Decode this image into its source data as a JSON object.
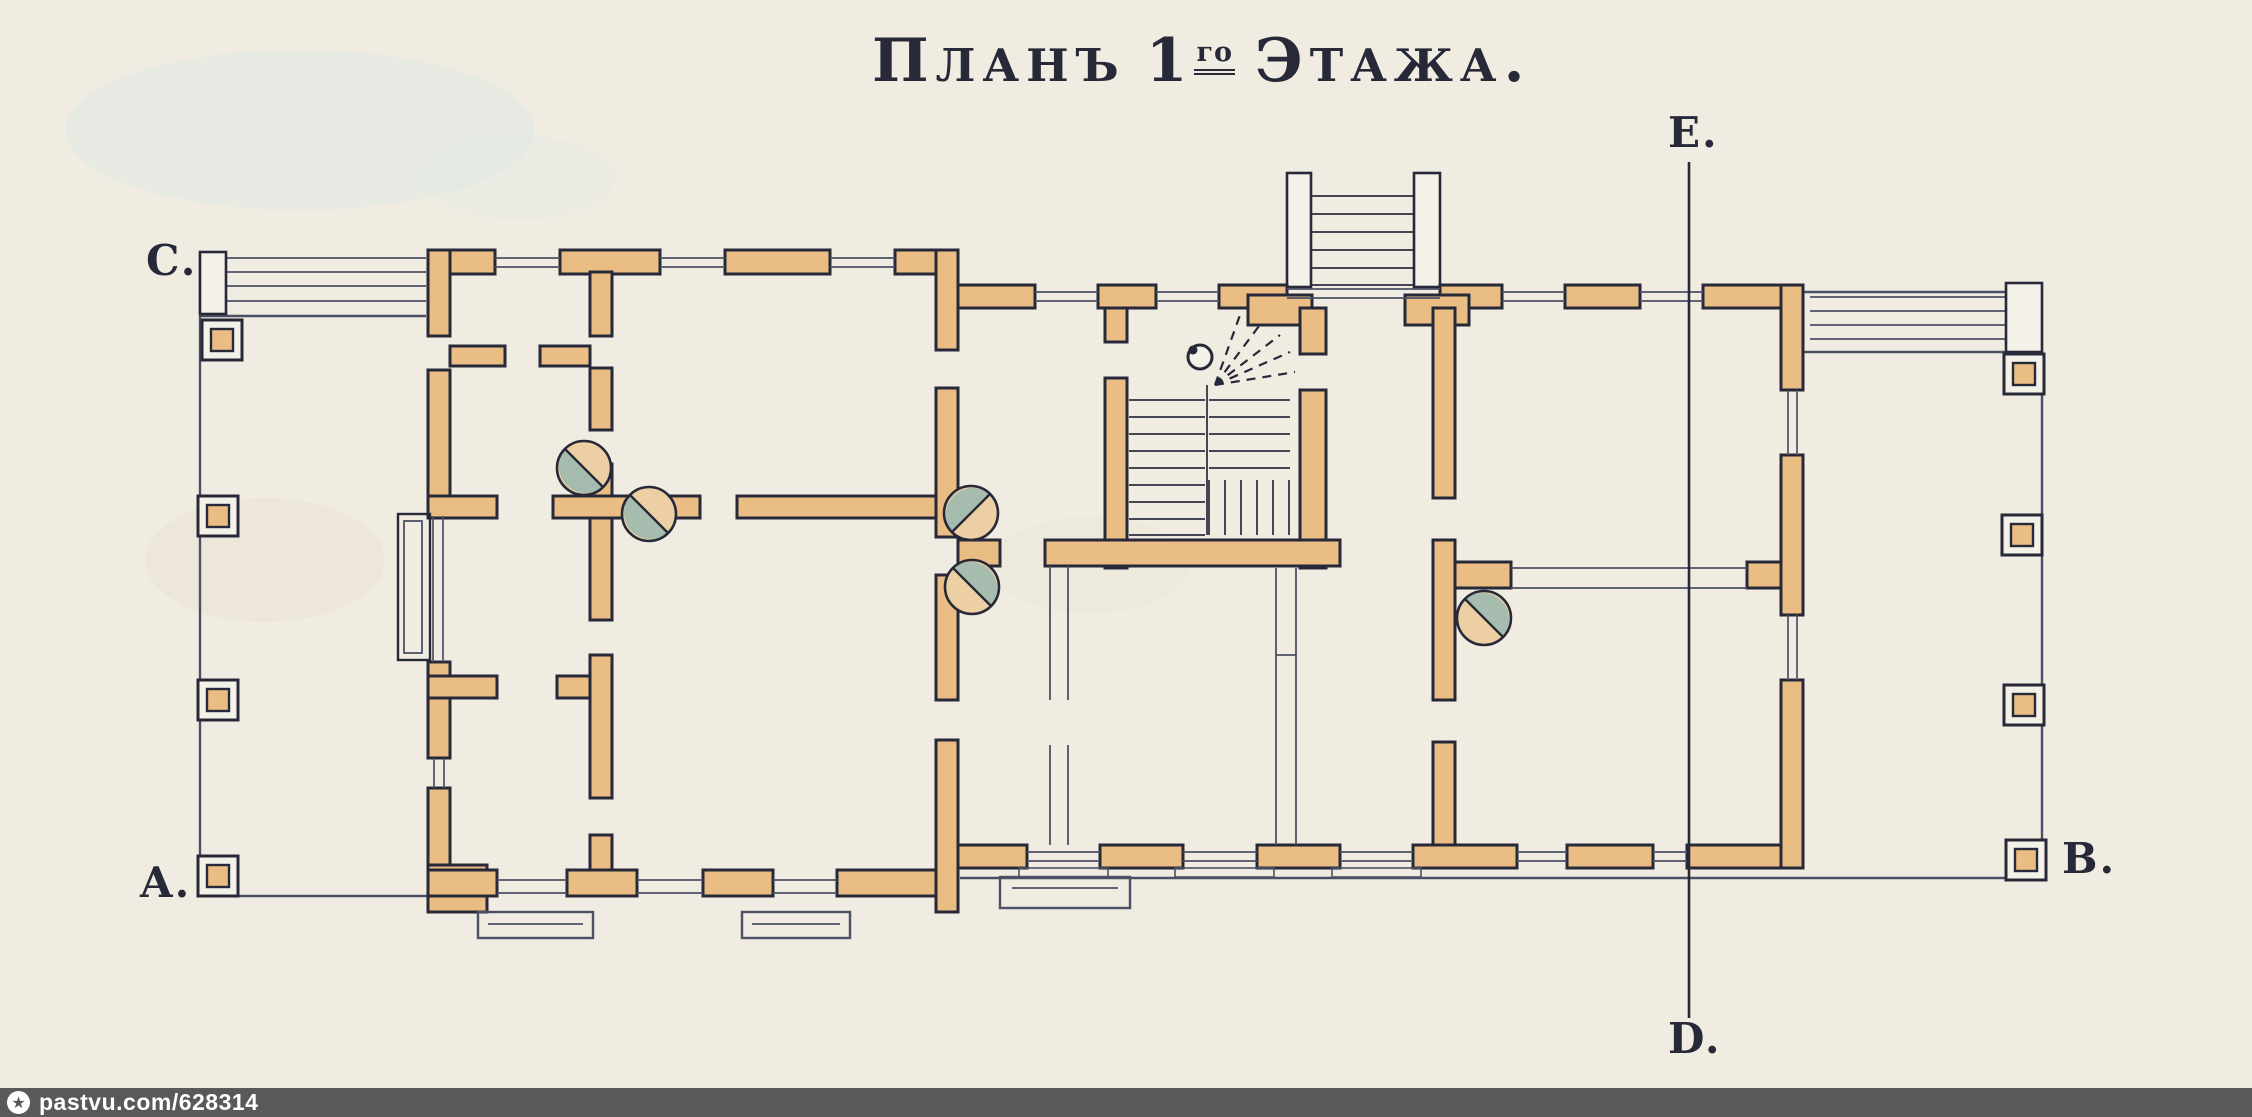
{
  "title": {
    "w1i": "П",
    "w1r": "ЛАНЪ",
    "num": "1",
    "sup": "го",
    "w2i": "Э",
    "w2r": "ТАЖА",
    "period": "."
  },
  "markers": {
    "e": "E.",
    "c": "C.",
    "a": "A.",
    "b": "B.",
    "d": "D."
  },
  "watermark": {
    "text": "pastvu.com/628314",
    "icon": "star-in-circle"
  },
  "colors": {
    "paper": "#f0ece1",
    "ink": "#272939",
    "line": "#4b5065",
    "wall": "#e9bd83",
    "teal": "#a6bcae",
    "stove_tan": "#eccfa2",
    "post": "#f4f1e9",
    "bar": "#59585a",
    "bar_text": "#ffffff"
  }
}
